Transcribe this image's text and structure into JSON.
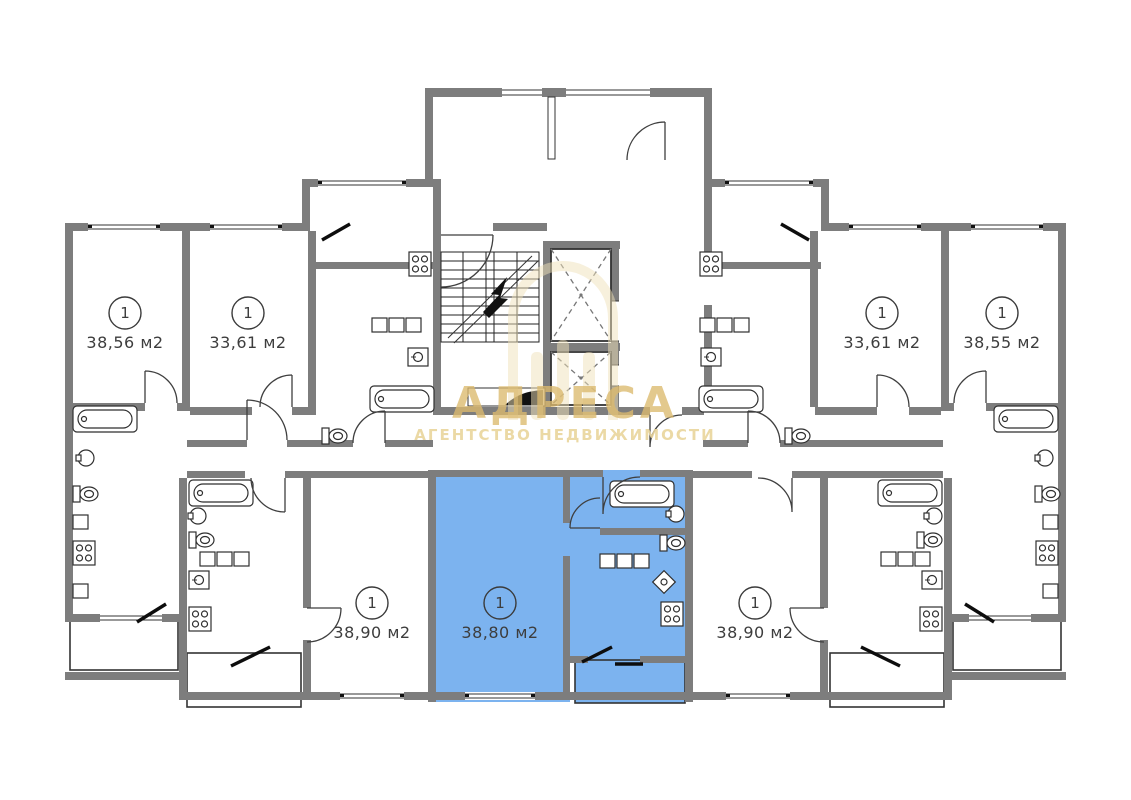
{
  "plan": {
    "type": "apartment-building-floor-plan",
    "colors": {
      "wall": "#7d7d7d",
      "line": "#2f2f2f",
      "highlight": "#7cb3ef",
      "watermark_title": "#dcba6e",
      "watermark_subtitle": "#e9d59c",
      "watermark_logo": "#f0e2ba",
      "background": "#ffffff"
    },
    "apartments": [
      {
        "number": "1",
        "area": "38,56 м2",
        "highlighted": false,
        "position": "top-left-outer"
      },
      {
        "number": "1",
        "area": "33,61 м2",
        "highlighted": false,
        "position": "top-left-inner"
      },
      {
        "number": "1",
        "area": "33,61 м2",
        "highlighted": false,
        "position": "top-right-inner"
      },
      {
        "number": "1",
        "area": "38,55 м2",
        "highlighted": false,
        "position": "top-right-outer"
      },
      {
        "number": "1",
        "area": "38,90 м2",
        "highlighted": false,
        "position": "bottom-left"
      },
      {
        "number": "1",
        "area": "38,80 м2",
        "highlighted": true,
        "position": "bottom-center"
      },
      {
        "number": "1",
        "area": "38,90 м2",
        "highlighted": false,
        "position": "bottom-right"
      }
    ],
    "watermark": {
      "title": "АДРЕСА",
      "subtitle": "АГЕНТСТВО НЕДВИЖИМОСТИ"
    }
  }
}
